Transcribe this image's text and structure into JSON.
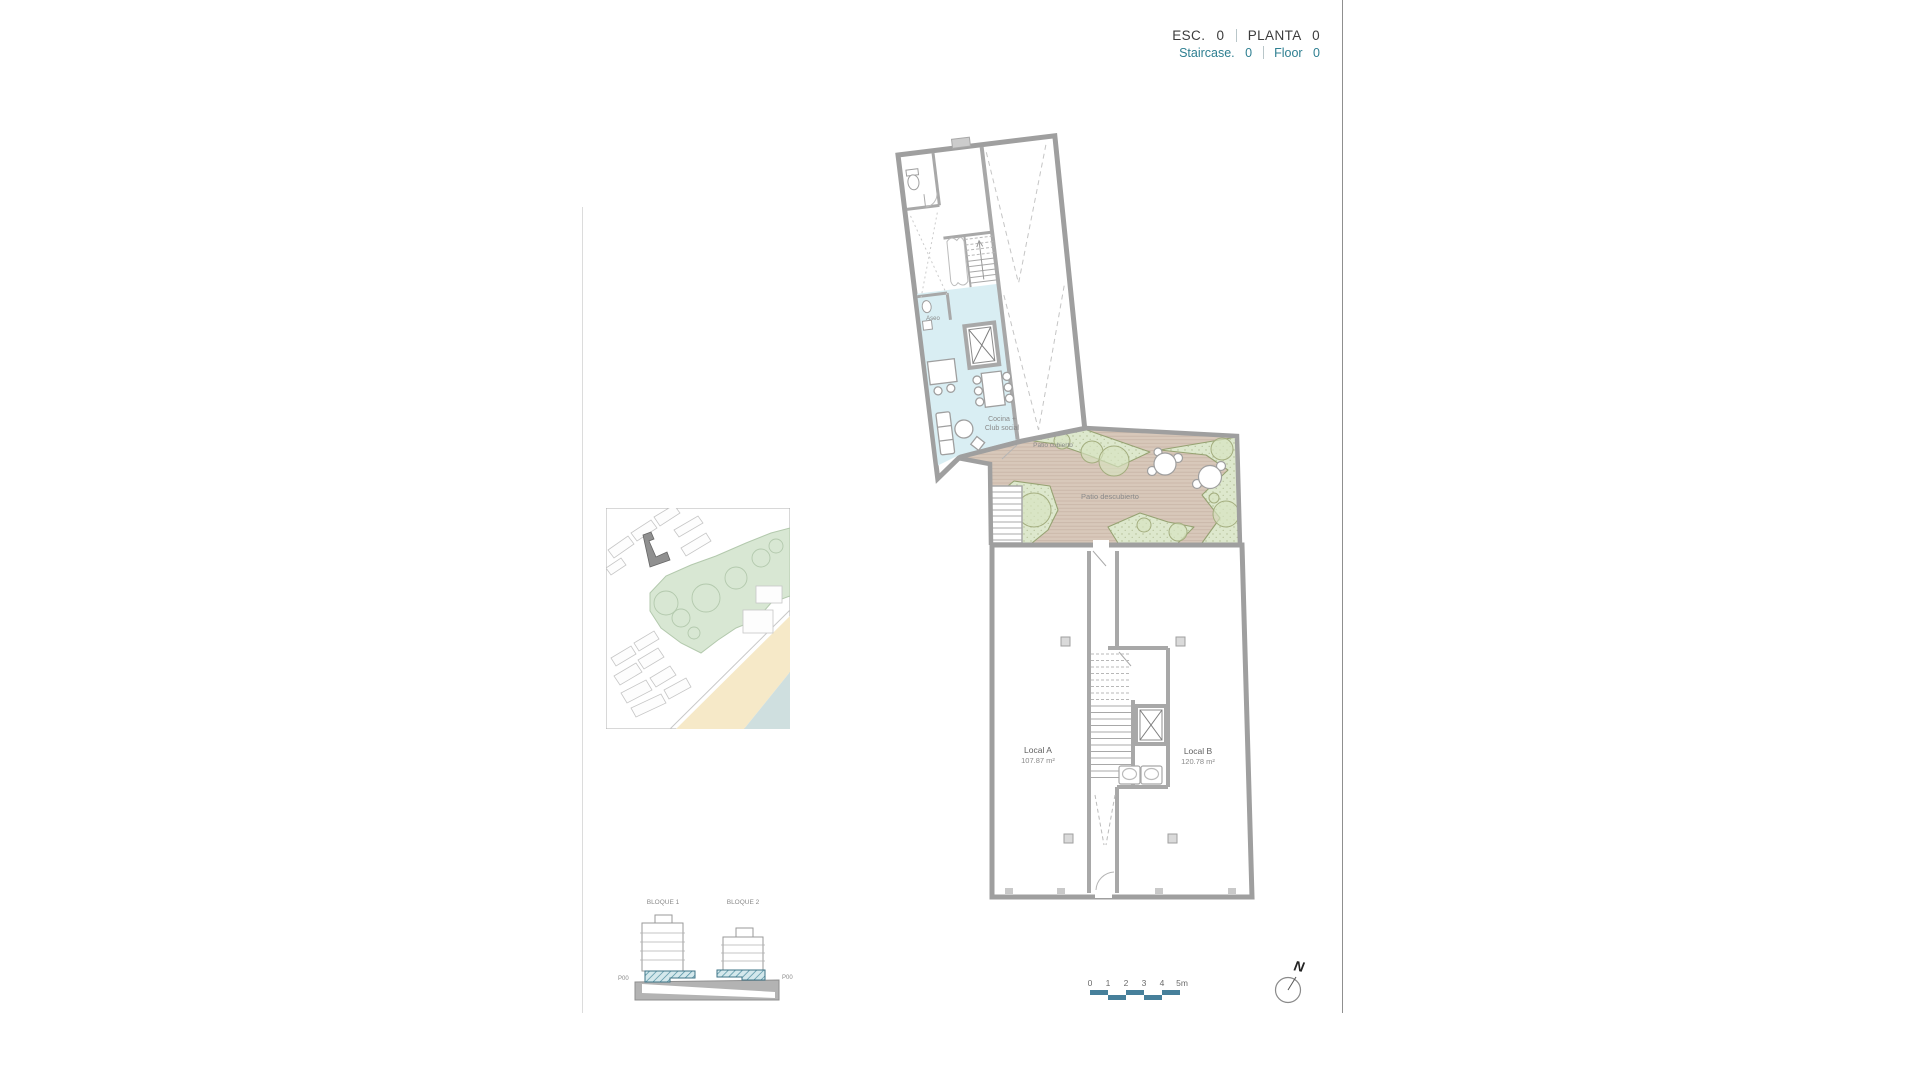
{
  "header": {
    "esc_label": "ESC.",
    "esc_value": "0",
    "planta_label": "PLANTA",
    "planta_value": "0",
    "staircase_label": "Staircase.",
    "staircase_value": "0",
    "floor_label": "Floor",
    "floor_value": "0"
  },
  "plan": {
    "labels": {
      "aseo": "Aseo",
      "cocina_line1": "Cocina +",
      "cocina_line2": "Club social",
      "patio_cubierto": "Patio cubierto",
      "patio_descubierto": "Patio descubierto",
      "local_a_name": "Local A",
      "local_a_area": "107.87 m²",
      "local_b_name": "Local B",
      "local_b_area": "120.78 m²"
    },
    "colors": {
      "accent_teal": "#2e7f91",
      "wall_gray": "#9f9f9f",
      "club_room_cyan": "#d9eef3",
      "deck_brown": "#d8c8ba",
      "garden_green": "#dde8cd",
      "scalebar_teal": "#47809b",
      "map_sand": "#f6e9c8",
      "map_water": "#cfdfdf"
    }
  },
  "elevation": {
    "bloque1_label": "BLOQUE 1",
    "bloque2_label": "BLOQUE 2",
    "p00_left": "P00",
    "p00_right": "P00"
  },
  "scalebar": {
    "ticks": [
      "0",
      "1",
      "2",
      "3",
      "4"
    ],
    "last": "5m"
  },
  "north": {
    "label": "N"
  }
}
